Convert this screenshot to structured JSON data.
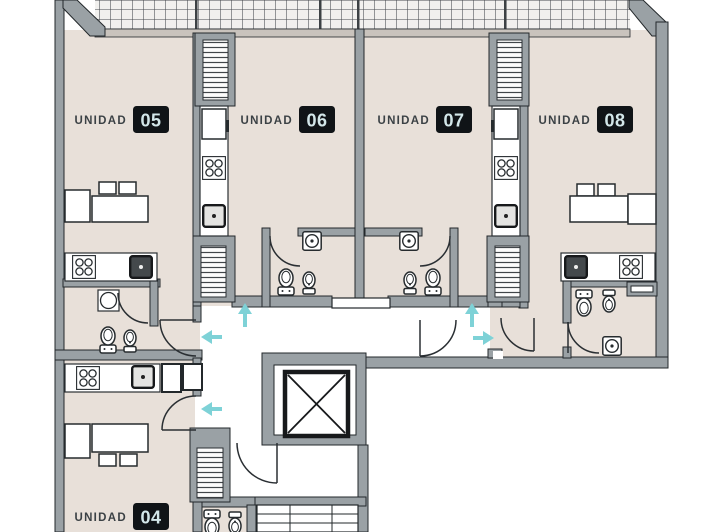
{
  "floor_plan": {
    "type": "apartment-floor-plan",
    "units": [
      {
        "id": "04",
        "label": "UNIDAD",
        "number": "04"
      },
      {
        "id": "05",
        "label": "UNIDAD",
        "number": "05"
      },
      {
        "id": "06",
        "label": "UNIDAD",
        "number": "06"
      },
      {
        "id": "07",
        "label": "UNIDAD",
        "number": "07"
      },
      {
        "id": "08",
        "label": "UNIDAD",
        "number": "08"
      }
    ],
    "circulation_arrows": [
      {
        "direction": "up",
        "location": "corridor-left"
      },
      {
        "direction": "left",
        "location": "corridor-upper"
      },
      {
        "direction": "left",
        "location": "corridor-lower"
      },
      {
        "direction": "up",
        "location": "corridor-right"
      },
      {
        "direction": "right",
        "location": "corridor-right"
      }
    ],
    "icons": [
      "terrace-grid",
      "ventilation-shaft",
      "refrigerator",
      "kitchen-stove",
      "kitchen-sink",
      "toilet",
      "bidet",
      "washing-machine",
      "shower",
      "dining-table",
      "chair",
      "elevator",
      "stairs",
      "door-swing"
    ],
    "colors": {
      "floor": "#e8e0d9",
      "wall": "#9aa1a5",
      "wall_outline": "#23282b",
      "corridor": "#ffffff",
      "arrow_accent": "#7ed2d7",
      "label_badge_bg": "#101417",
      "label_badge_text": "#d3e7e9",
      "label_text": "#3b4145"
    }
  }
}
